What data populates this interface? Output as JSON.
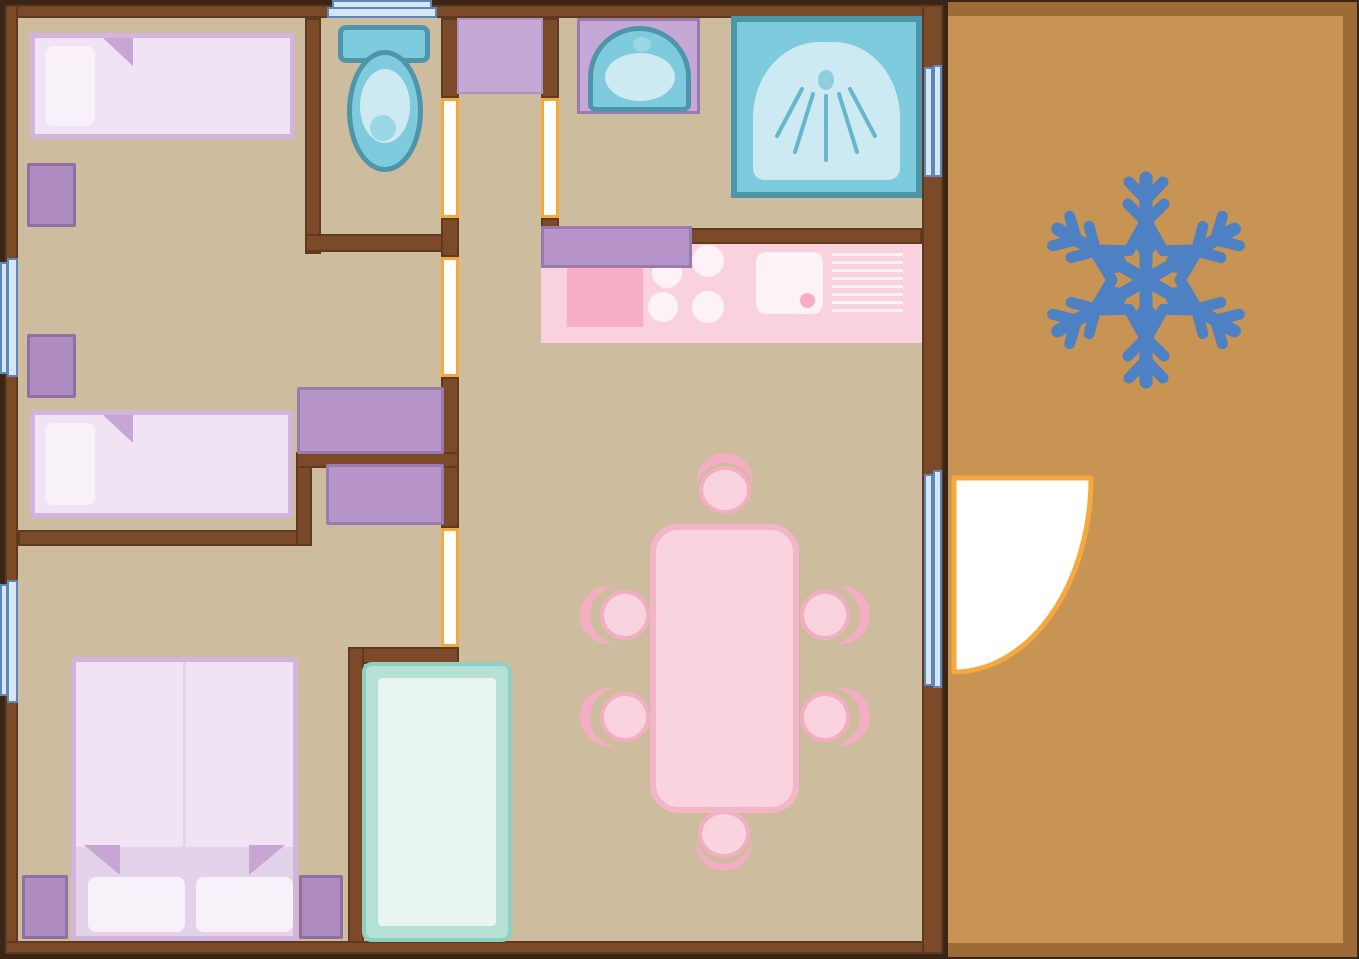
{
  "diagram": {
    "kind": "floor-plan",
    "theme": "winter-cabin",
    "motif_icon": "snowflake-icon"
  },
  "inventory": {
    "bedroom_top_left": [
      "single-bed",
      "pillow",
      "nightstand"
    ],
    "bedroom_mid_left": [
      "single-bed",
      "pillow",
      "nightstand",
      "wardrobe",
      "wardrobe"
    ],
    "bedroom_bottom_left": [
      "double-bed",
      "pillow",
      "pillow",
      "nightstand",
      "nightstand",
      "tall-wardrobe"
    ],
    "wc": [
      "toilet"
    ],
    "bathroom": [
      "vanity-sink",
      "shower"
    ],
    "hallway": [
      "cabinet"
    ],
    "kitchen": [
      "counter",
      "hob-burners",
      "sink",
      "drainboard",
      "worktop"
    ],
    "living_room": [
      "dining-table",
      "chair",
      "chair",
      "chair",
      "chair",
      "chair",
      "chair"
    ],
    "terrace": [
      "deck",
      "snowflake-motif",
      "glass-door",
      "door-swing"
    ]
  },
  "counts": {
    "beds": 3,
    "chairs": 6,
    "internal_doors": 4,
    "windows": 4,
    "nightstands": 4
  },
  "colors": {
    "wall": "#7b4a28",
    "wall_edge": "#5e3a1e",
    "outline": "#3b2517",
    "floor": "#cdbc9e",
    "terrace": "#c79454",
    "terrace_border": "#9c6b38",
    "win_fill": "#d7e6f5",
    "win_edge": "#5c87b8",
    "door_orange": "#f5a93c",
    "purple": "#b795ca",
    "purple_edge": "#997bae",
    "purple_light": "#c6a8d6",
    "purple_light_edge": "#b190c4",
    "stand": "#ae8bc0",
    "stand_edge": "#8f6fa4",
    "bed_edge": "#d2b4dd",
    "bed_fill": "#f0e3f4",
    "bed_base": "#e3d3ea",
    "pillow": "#f8f1fa",
    "fold": "#c7a6d4",
    "teal_edge": "#4e95aa",
    "teal_fill": "#7ecbde",
    "teal_light": "#cdeaf2",
    "teal_mid": "#9bd8e6",
    "pink": "#fad2dd",
    "pink_dark": "#f5aec3",
    "pink_white": "#fdf2f5",
    "table_fill": "#f9d4df",
    "table_edge": "#f3b5c8",
    "crescent": "#f3aec3",
    "mint_edge": "#8fd0c2",
    "mint_fill": "#b5e0d6",
    "mint_inner": "#e8f5f1",
    "snowflake": "#4e80c4",
    "white": "#ffffff"
  }
}
